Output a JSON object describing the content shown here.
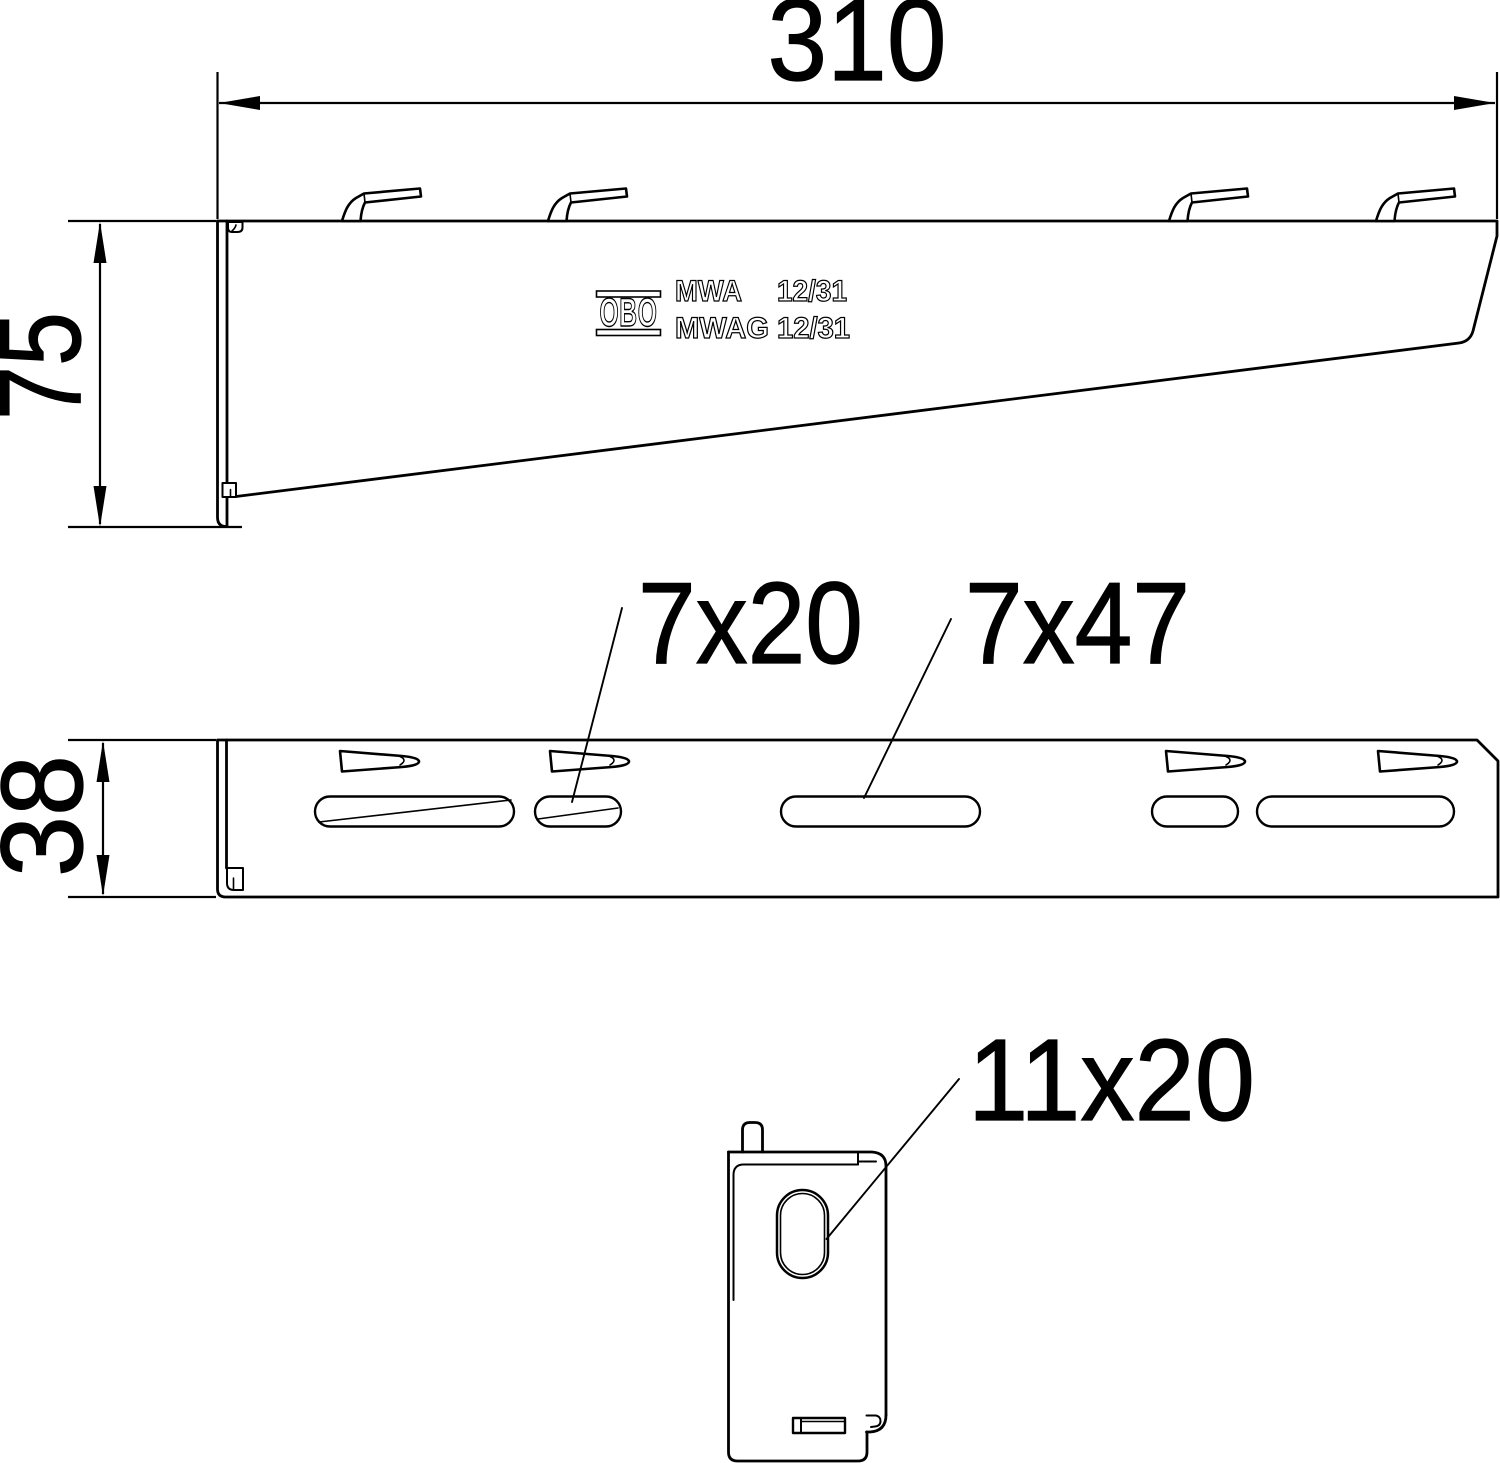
{
  "colors": {
    "line": "#000000",
    "background": "#ffffff"
  },
  "dimensions": {
    "width": "310",
    "height": "75",
    "depth": "38"
  },
  "callouts": {
    "small_slot": "7x20",
    "large_slot": "7x47",
    "oval_slot": "11x20"
  },
  "stamp": {
    "logo": "OBO",
    "model_a": "MWA",
    "size_a": "12/31",
    "model_b": "MWAG 12/31"
  }
}
